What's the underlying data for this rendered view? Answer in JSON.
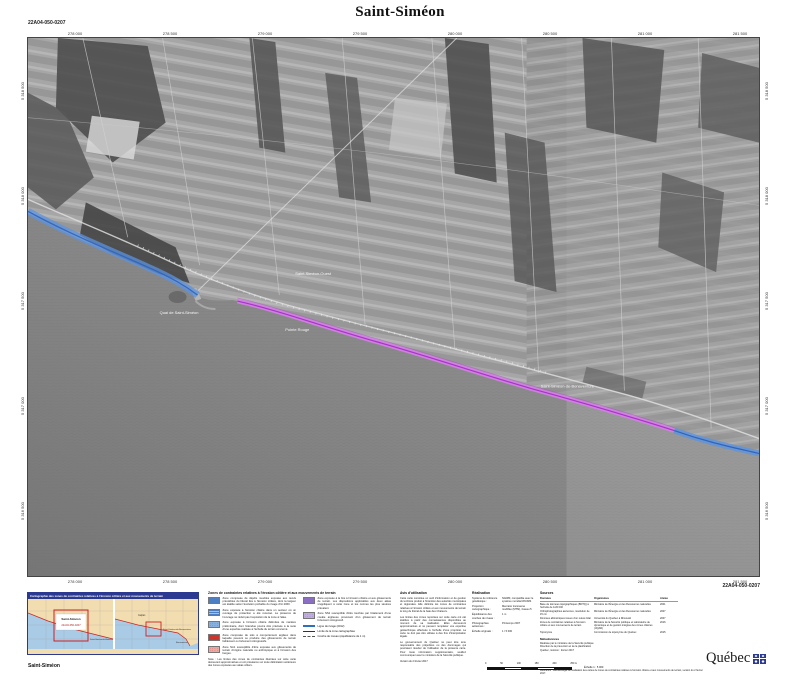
{
  "sheet": {
    "code": "22A04-050-0207",
    "title": "Saint-Siméon"
  },
  "frame": {
    "top_ticks": [
      "278 000",
      "278 500",
      "279 000",
      "279 500",
      "280 000",
      "280 500",
      "281 000",
      "281 500"
    ],
    "bottom_ticks": [
      "278 000",
      "278 500",
      "279 000",
      "279 500",
      "280 000",
      "280 500",
      "281 000",
      "281 500"
    ],
    "left_ticks": [
      "5 318 500",
      "5 318 000",
      "5 317 500",
      "5 317 000",
      "5 316 500"
    ],
    "right_ticks": [
      "5 318 500",
      "5 318 000",
      "5 317 500",
      "5 317 000",
      "5 316 500"
    ]
  },
  "map": {
    "labels": {
      "west_sector": "Saint-Siméon-Ouest",
      "wharf": "Quai de Saint-Siméon",
      "point": "Pointe Rouge",
      "village": "Saint-Siméon-de-Bonaventure"
    },
    "overlays": {
      "erosion_color": "#5d93dd",
      "combined_color": "#c253d8"
    }
  },
  "locator": {
    "header": "Cartographie des zones de contraintes relatives à l'érosion côtière et aux mouvements de terrain",
    "sheet_box": {
      "line1": "Saint-Siméon",
      "line2": "22A04-050-0207"
    },
    "left_label": "Saint-Siméon-de-Bonaventure",
    "right_labels": [
      "Caplan",
      "Saint-Siméon-de-Bonaventure",
      "Bonaventure"
    ],
    "caption": "Saint-Siméon"
  },
  "legend": {
    "title": "Zones de contraintes relatives à l'érosion côtière et aux mouvements de terrain",
    "items": [
      {
        "text": "Zone composée de dépôts meubles exposée aux reculs prévisibles du littoral liés à l'érosion côtière, dont la largeur est établie selon l'évolution probable du rivage d'ici 2060."
      },
      {
        "text": "Zone exposée à l'érosion côtière dans un secteur où un ouvrage de protection a été recensé. La présence de l'ouvrage ne réduit pas l'exposition de la zone à l'aléa."
      },
      {
        "text": "Zone exposée à l'érosion côtière délimitée de manière préliminaire, dont l'étendue pourra être précisée à la suite d'une expertise réalisée à l'échelle du terrain concerné."
      },
      {
        "text": "Zone composée de sols à comportement argileux dans laquelle peuvent se produire des glissements de terrain faiblement ou fortement rétrogressifs."
      },
      {
        "text": "Zone NA1 susceptible d'être exposée aux glissements de terrain d'origine naturelle ou anthropique et à l'érosion des berges."
      },
      {
        "text": "Zone exposée à la fois à l'érosion côtière et aux glissements de terrain. Les dispositions applicables aux deux aléas s'appliquent à cette zone et les normes les plus sévères prévalent."
      },
      {
        "text": "Zone NS2 susceptible d'être touchée par l'étalement d'une coulée argileuse provenant d'un glissement de terrain fortement rétrogressif."
      }
    ],
    "symbols": [
      {
        "label": "Ligne de rivage (2012)"
      },
      {
        "label": "Limite de la zone cartographiée"
      },
      {
        "label": "Courbe de niveau (équidistance de 1 m)"
      }
    ],
    "nota": "Nota : Les limites des zones de contraintes illustrées sur cette carte demeurent approximatives et ont préséance sur toute délimitation antérieure des zones exposées aux aléas côtiers."
  },
  "avis": {
    "title": "Avis d'utilisation",
    "paragraphs": [
      "Cette carte constitue un outil d'information et de gestion du territoire produit à l'intention des autorités municipales et régionales. Elle délimite les zones de contraintes relatives à l'érosion côtière et aux mouvements de terrain le long du littoral de la baie des Chaleurs.",
      "Les limites des zones reportées sur cette carte ont été établies à partir des connaissances disponibles au moment de sa réalisation. Elles demeurent approximatives et ne peuvent remplacer une expertise géotechnique effectuée à l'échelle d'une propriété. La carte ne doit pas être utilisée à des fins d'interprétation légale.",
      "Le gouvernement du Québec ne peut être tenu responsable des préjudices ou des dommages qui pourraient résulter de l'utilisation de la présente carte. Pour toute information supplémentaire, veuillez communiquer avec le ministère de la Sécurité publique."
    ],
    "footer": "Version du 2 février 2017"
  },
  "references": {
    "title": "Réalisation",
    "rows": [
      {
        "label": "Système de référence géodésique :",
        "value": "NAD83, compatible avec le système mondial WGS84"
      },
      {
        "label": "Projection cartographique :",
        "value": "Mercator transverse modifiée (MTM), fuseau 5"
      },
      {
        "label": "Équidistance des courbes de niveau :",
        "value": "1 m"
      },
      {
        "label": "Photographies aériennes :",
        "value": "Printemps 2007"
      },
      {
        "label": "Échelle originale :",
        "value": "1 / 5 000"
      }
    ],
    "scale_ticks": [
      "0",
      "50",
      "100",
      "150",
      "200",
      "250 m"
    ],
    "scale_caption": "Échelle 1 : 5 000"
  },
  "sources": {
    "title": "Sources",
    "columns": [
      "Données",
      "Organismes",
      "Année"
    ],
    "rows": [
      {
        "data": "Base de données topographiques (BDTQ) à l'échelle de 1/20 000",
        "org": "Ministère de l'Énergie et des Ressources naturelles",
        "year": "2001"
      },
      {
        "data": "Orthophotographies aériennes, résolution de 15 cm",
        "org": "Ministère de l'Énergie et des Ressources naturelles",
        "year": "2007"
      },
      {
        "data": "Données altimétriques issues d'un relevé lidar",
        "org": "Université du Québec à Rimouski",
        "year": "2007"
      },
      {
        "data": "Zones de contraintes relatives à l'érosion côtière et aux mouvements de terrain",
        "org": "Ministère de la Sécurité publique et Laboratoire de dynamique et de gestion intégrée des zones côtières (UQAR)",
        "year": "2016"
      },
      {
        "data": "Toponymie",
        "org": "Commission de toponymie du Québec",
        "year": "2015"
      }
    ],
    "credits": {
      "title": "Métadonnées",
      "lines": [
        "Réalisée par le ministère de la Sécurité publique",
        "Direction de la prévention et de la planification",
        "Québec, révision : février 2017"
      ]
    },
    "footnote": "Référence : Méthodologie de réalisation des cartes de zones de contraintes relatives à l'érosion côtière et aux mouvements de terrain, version du 2 février 2017."
  },
  "logo": {
    "wordmark": "Québec"
  }
}
